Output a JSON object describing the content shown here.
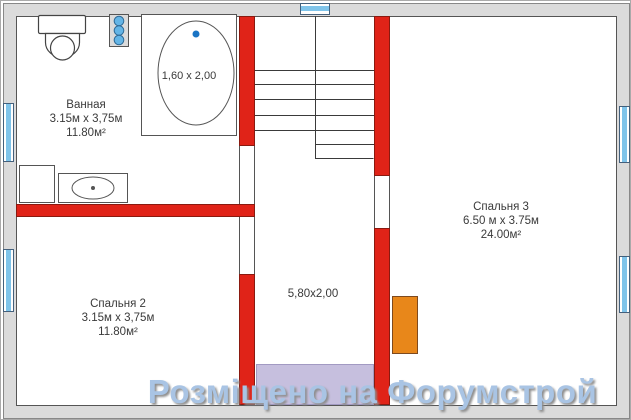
{
  "plan_type": "floor-plan",
  "rooms": {
    "bathroom": {
      "name": "Ванная",
      "dims": "3.15м x 3,75м",
      "area": "11.80м²"
    },
    "bedroom2": {
      "name": "Спальня 2",
      "dims": "3.15м x 3,75м",
      "area": "11.80м²"
    },
    "bedroom3": {
      "name": "Спальня 3",
      "dims": "6.50 м x 3.75м",
      "area": "24.00м²"
    },
    "corridor": {
      "dims": "5,80х2,00"
    }
  },
  "fixtures": {
    "bathtub_label": "1,60 x 2,00",
    "icons": [
      "toilet-icon",
      "radiator-icon",
      "bathtub-icon",
      "washing-machine-icon",
      "sink-icon",
      "staircase",
      "window-symbol",
      "wardrobe-block",
      "stair-landing"
    ]
  },
  "watermark": {
    "text": "Розміщено на Форумстрой"
  },
  "colors": {
    "wall_gray": "#dbdbdb",
    "wall_red": "#e02318",
    "window_blue": "#7fc4ea",
    "landing_lavender": "#c6bfde",
    "wardrobe_orange": "#e8871a",
    "watermark_blue": "#a9c4e4",
    "line_dark": "#555555"
  }
}
